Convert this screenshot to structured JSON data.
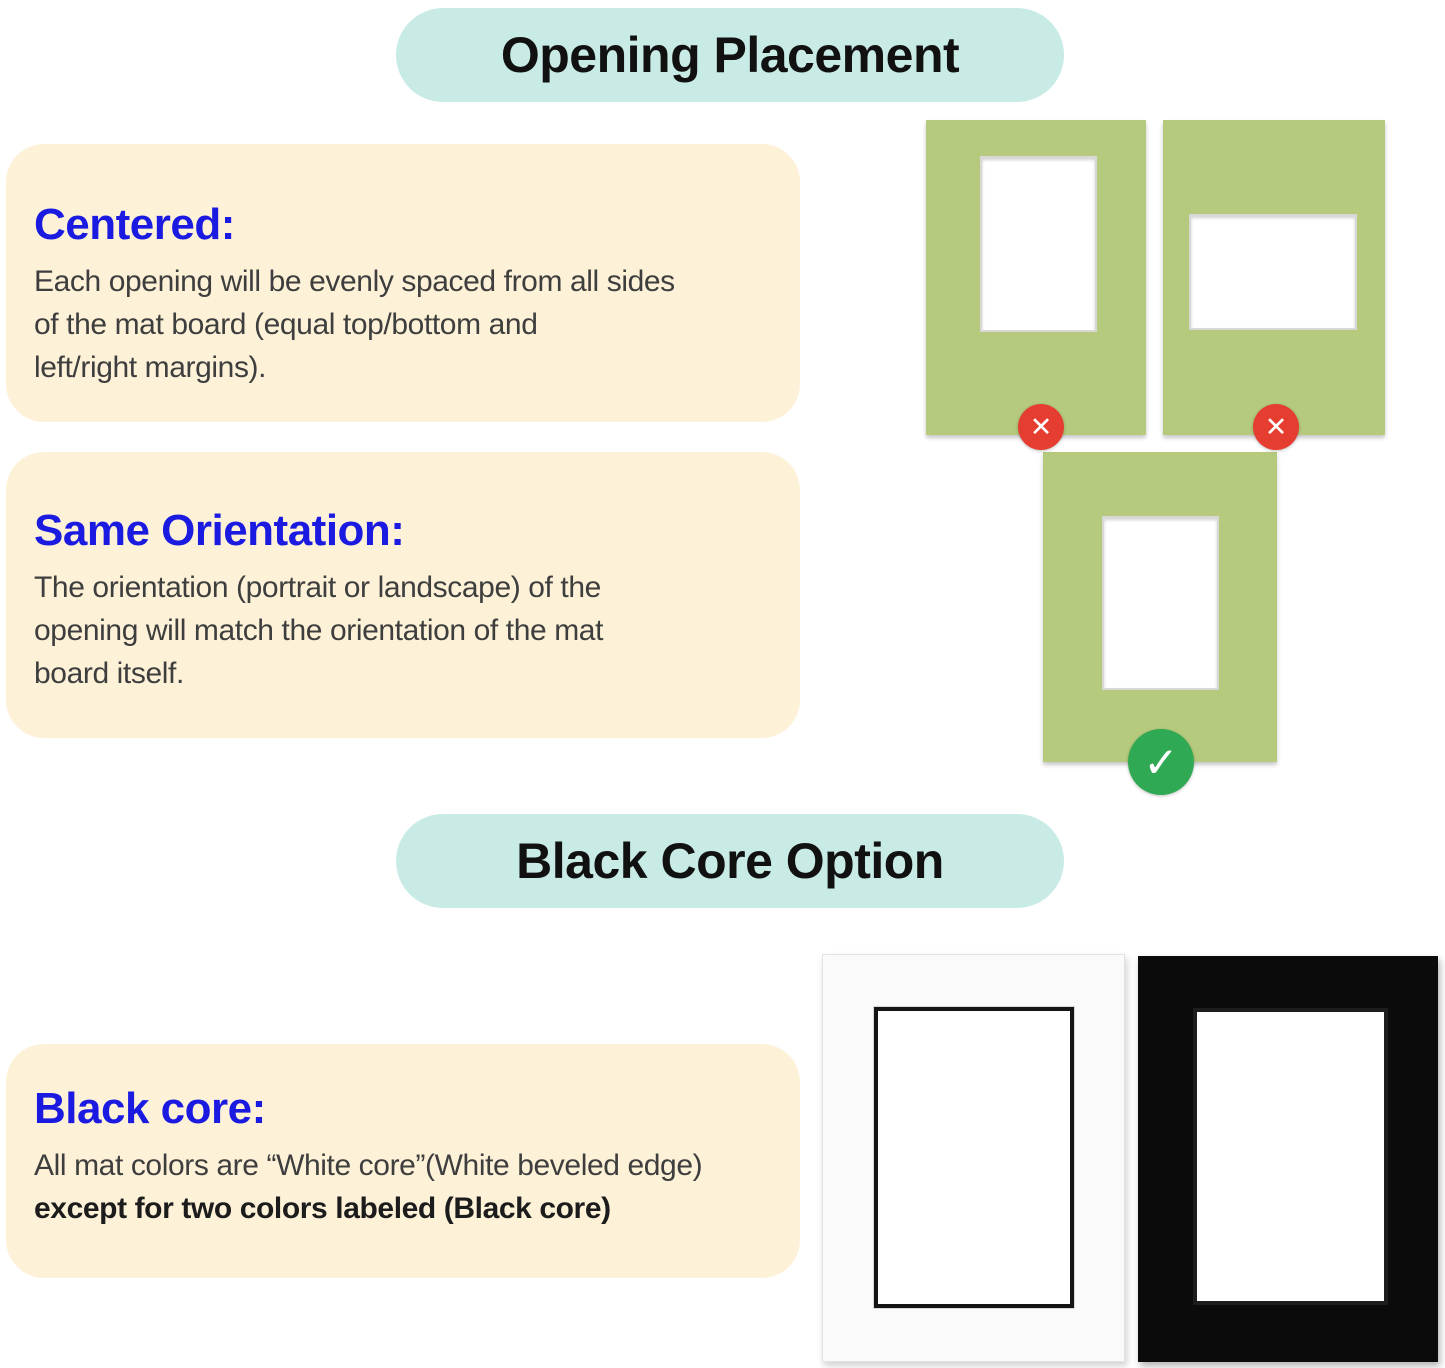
{
  "colors": {
    "accent_cyan": "#c8ebe5",
    "note_cream": "#fdf2d8",
    "heading_blue": "#1a1ae0",
    "mat_green": "#b5ca7c",
    "wrong_red": "#e53e30",
    "correct_green": "#2fa953",
    "ink": "#111111",
    "body_gray": "#3e3e3e"
  },
  "icons": {
    "wrong_mark": "✕",
    "check_mark": "✓"
  },
  "opening_placement": {
    "header": "Opening Placement",
    "centered": {
      "heading": "Centered:",
      "body": "Each opening will be evenly spaced from all sides\nof the mat board (equal top/bottom and\nleft/right margins)."
    },
    "same_orientation": {
      "heading": "Same Orientation:",
      "body": "The orientation (portrait or landscape) of the\nopening will match the orientation of the mat\nboard itself."
    },
    "mat_examples": [
      {
        "name": "off-center-opening",
        "verdict": "wrong"
      },
      {
        "name": "landscape-opening-on-portrait-mat",
        "verdict": "wrong"
      },
      {
        "name": "centered-same-orientation-opening",
        "verdict": "correct"
      }
    ]
  },
  "black_core": {
    "header": "Black Core Option",
    "note": {
      "heading": "Black core:",
      "line_regular": "All mat colors are “White core”(White beveled edge)",
      "line_bold": "except for two colors labeled (Black core)"
    },
    "mat_examples": [
      {
        "name": "white-mat-black-core",
        "core": "black"
      },
      {
        "name": "black-mat",
        "core": "black"
      }
    ]
  }
}
